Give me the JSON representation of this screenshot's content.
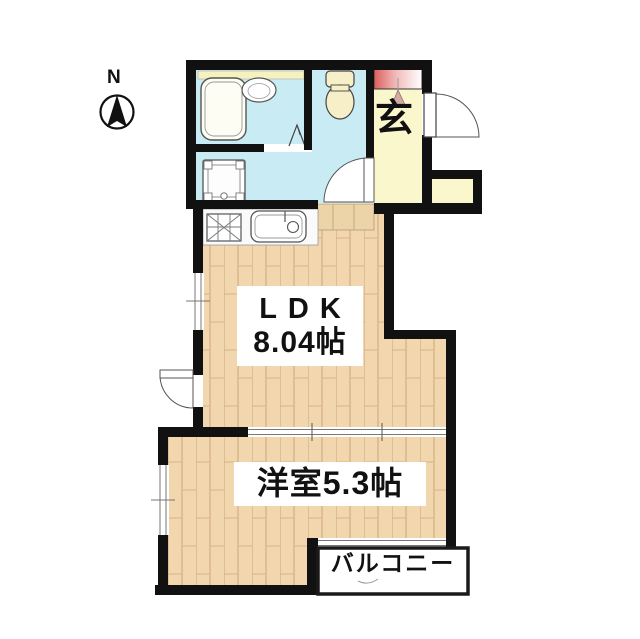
{
  "document": {
    "kind": "japanese-apartment-floor-plan"
  },
  "compass": {
    "label": "N"
  },
  "rooms": {
    "ldk": {
      "name": "LDK",
      "size": "8.04帖"
    },
    "western_room": {
      "label": "洋室5.3帖"
    },
    "balcony": {
      "label": "バルコニー"
    },
    "entrance": {
      "label": "玄"
    }
  },
  "fixtures": [
    "bathtub",
    "washbasin",
    "toilet",
    "washing-machine",
    "gas-stove",
    "kitchen-sink",
    "folding-bath-door",
    "entrance-door",
    "washroom-door",
    "ldk-door",
    "shoe-cabinet",
    "entrance-step"
  ],
  "colors": {
    "wall": "#111111",
    "wet_area_floor": "#c9ecf4",
    "wood_floor": "#f2d7ae",
    "wood_floor_line": "#d8b488",
    "entrance_floor": "#fbf7cd",
    "step_floor": "#ecd3a8",
    "cabinet_accent": "#e06565",
    "fixture_cream": "#f7efc8",
    "background": "#ffffff"
  }
}
